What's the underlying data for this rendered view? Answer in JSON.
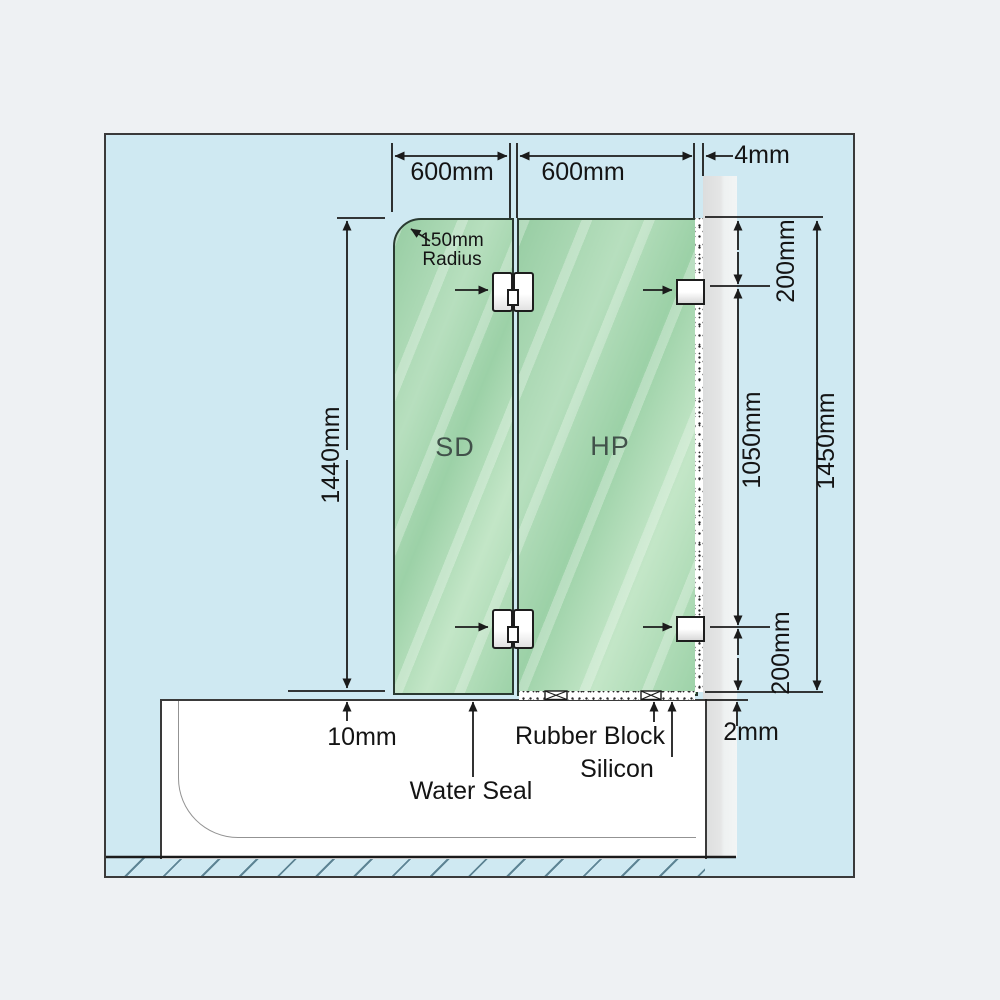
{
  "diagram": {
    "title": "Frameless bath shower screen installation diagram",
    "panels": {
      "sd": "SD",
      "hp": "HP"
    },
    "dims": {
      "sd_width": "600mm",
      "hp_width": "600mm",
      "wall_gap": "4mm",
      "corner_radius": "150mm\nRadius",
      "sd_height": "1440mm",
      "top_offset": "200mm",
      "bracket_spacing": "1050mm",
      "hp_height": "1450mm",
      "bottom_offset": "200mm",
      "sd_bottom_gap": "10mm",
      "hp_bottom_gap": "2mm"
    },
    "callouts": {
      "water_seal": "Water Seal",
      "rubber_block": "Rubber Block",
      "silicon": "Silicon"
    },
    "colors": {
      "canvas_bg": "#eef1f3",
      "panel_bg": "#cfe9f2",
      "glass_green": "#a9d8b3",
      "wall_gray": "#e2e3e3",
      "hatch_line": "#5d8494",
      "line": "#1b1b1b"
    }
  }
}
